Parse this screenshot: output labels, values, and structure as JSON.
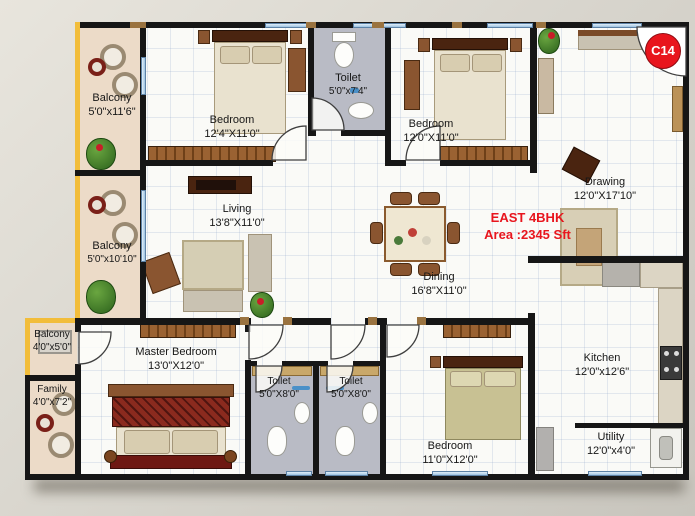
{
  "unit": {
    "badge": "C14",
    "type": "EAST 4BHK",
    "area": "Area :2345 Sft"
  },
  "rooms": {
    "balcony_top": {
      "name": "Balcony",
      "dims": "5'0\"x11'6\""
    },
    "bedroom_top_left": {
      "name": "Bedroom",
      "dims": "12'4\"X11'0\""
    },
    "toilet_top": {
      "name": "Toilet",
      "dims": "5'0\"x7'4\""
    },
    "bedroom_top_right": {
      "name": "Bedroom",
      "dims": "12'0\"X11'0\""
    },
    "drawing": {
      "name": "Drawing",
      "dims": "12'0\"X17'10\""
    },
    "living": {
      "name": "Living",
      "dims": "13'8\"X11'0\""
    },
    "balcony_mid": {
      "name": "Balcony",
      "dims": "5'0\"x10'10\""
    },
    "dining": {
      "name": "Dining",
      "dims": "16'8\"X11'0\""
    },
    "balcony_bottom": {
      "name": "Balcony",
      "dims": "4'0\"x5'0\""
    },
    "family": {
      "name": "Family",
      "dims": "4'0\"x7'2\""
    },
    "master_bedroom": {
      "name": "Master Bedroom",
      "dims": "13'0\"X12'0\""
    },
    "toilet_bottom_left": {
      "name": "Toilet",
      "dims": "5'0\"X8'0\""
    },
    "toilet_bottom_right": {
      "name": "Toilet",
      "dims": "5'0\"X8'0\""
    },
    "bedroom_bottom": {
      "name": "Bedroom",
      "dims": "11'0\"X12'0\""
    },
    "kitchen": {
      "name": "Kitchen",
      "dims": "12'0\"x12'6\""
    },
    "utility": {
      "name": "Utility",
      "dims": "12'0\"x4'0\""
    }
  },
  "colors": {
    "accent_red": "#e8151d",
    "balcony_yellow": "#f2bd3a",
    "wall_black": "#161616",
    "window_blue": "#9cc2e2"
  }
}
